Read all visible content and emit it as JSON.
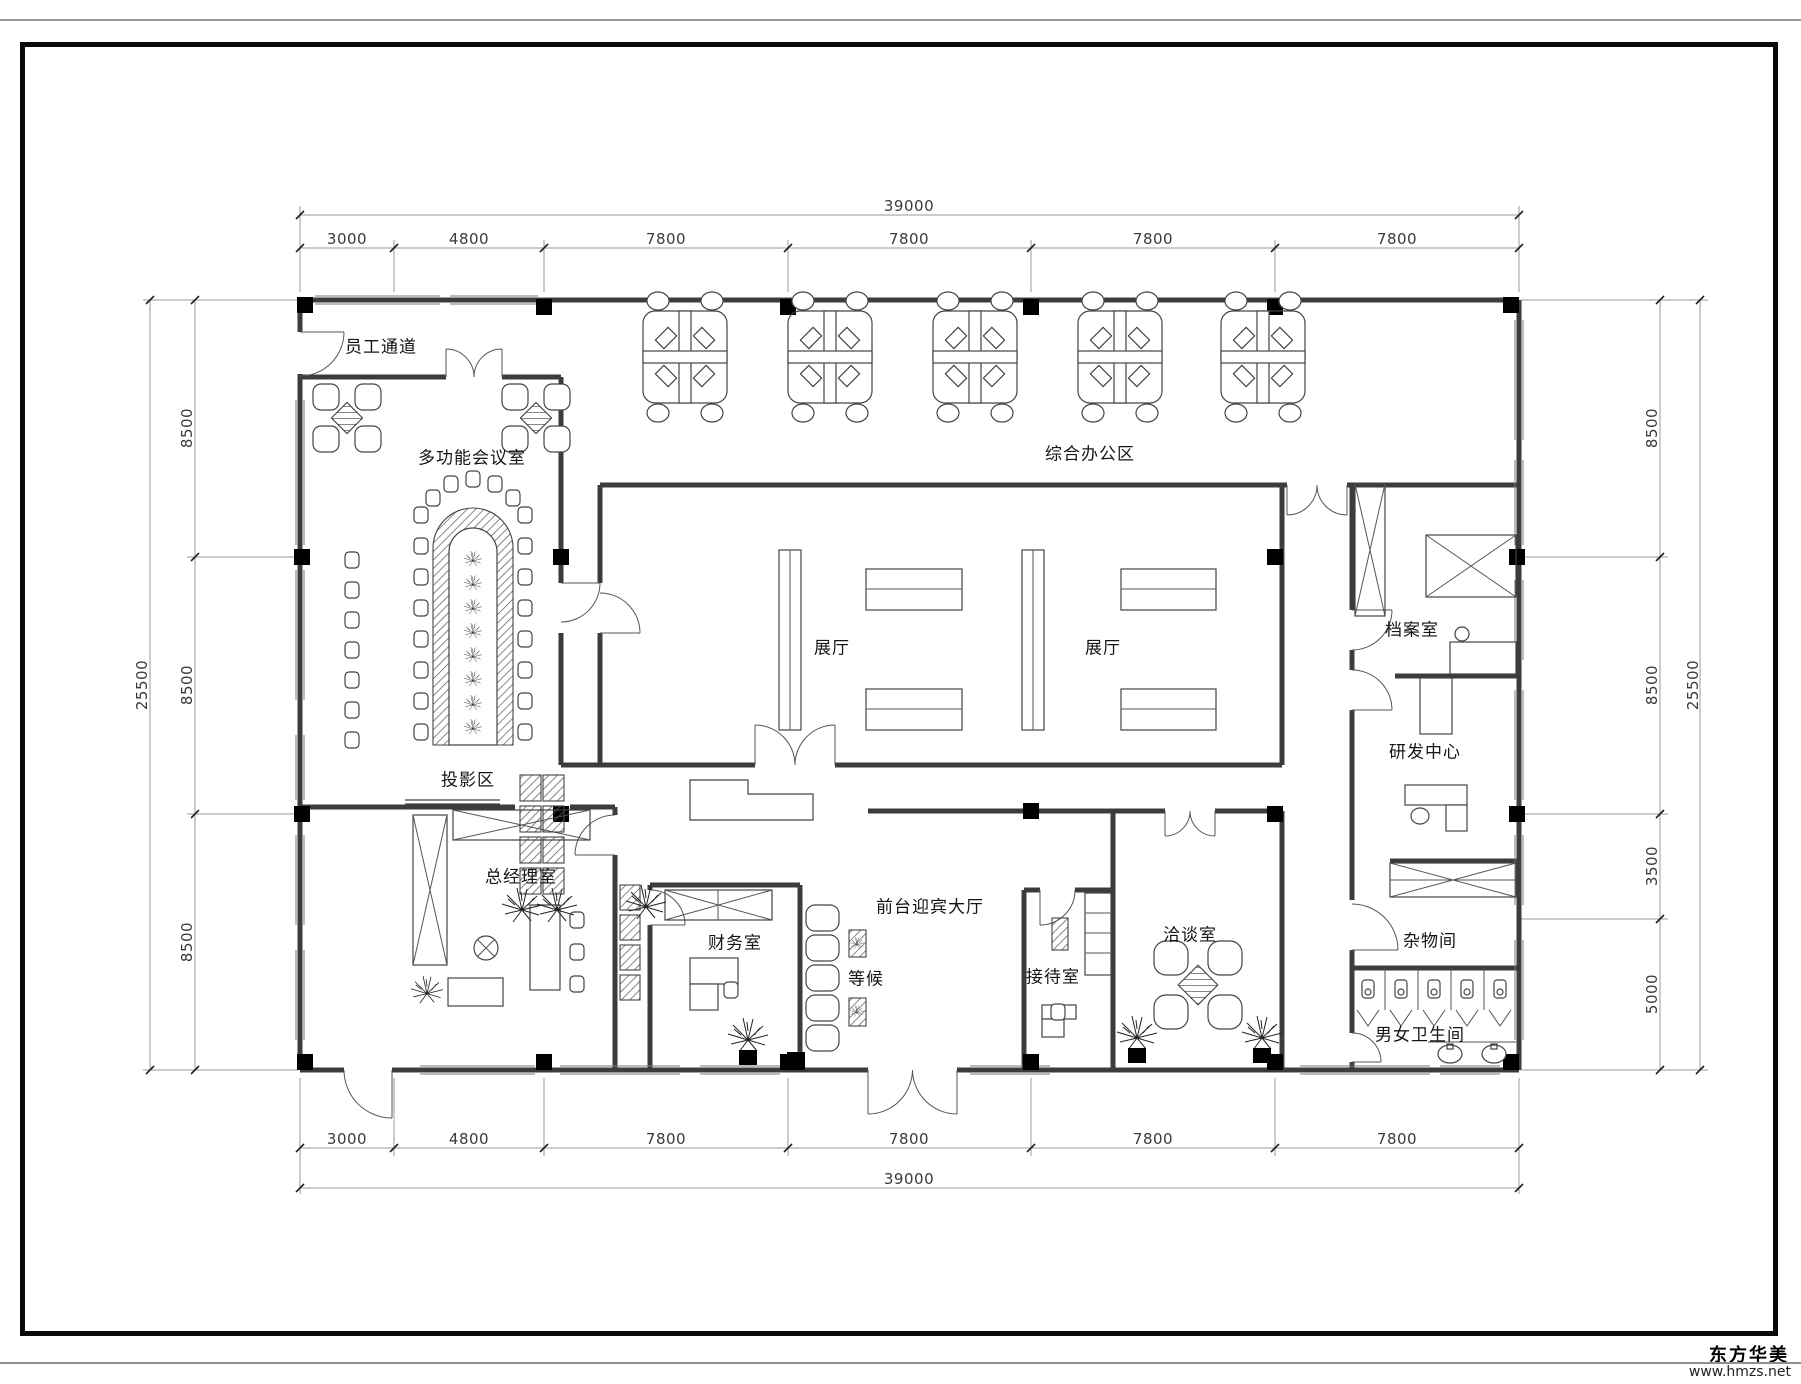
{
  "watermark": {
    "brand": "东方华美",
    "url": "www.hmzs.net"
  },
  "rooms": {
    "staff_corridor": "员工通道",
    "meeting_room": "多功能会议室",
    "office_area": "综合办公区",
    "exhibition_hall_1": "展厅",
    "exhibition_hall_2": "展厅",
    "archive_room": "档案室",
    "rd_center": "研发中心",
    "projection_area": "投影区",
    "gm_office": "总经理室",
    "finance_office": "财务室",
    "waiting": "等候",
    "lobby": "前台迎宾大厅",
    "reception_room": "接待室",
    "negotiation_room": "洽谈室",
    "storage_room": "杂物间",
    "restroom": "男女卫生间"
  },
  "dims": {
    "top": {
      "total": "39000",
      "segments": [
        "3000",
        "4800",
        "7800",
        "7800",
        "7800",
        "7800"
      ]
    },
    "bottom": {
      "total": "39000",
      "segments": [
        "3000",
        "4800",
        "7800",
        "7800",
        "7800",
        "7800"
      ]
    },
    "left": {
      "total": "25500",
      "segments": [
        "8500",
        "8500",
        "8500"
      ]
    },
    "right": {
      "total": "25500",
      "segments": [
        "8500",
        "8500",
        "3500",
        "5000"
      ]
    }
  }
}
